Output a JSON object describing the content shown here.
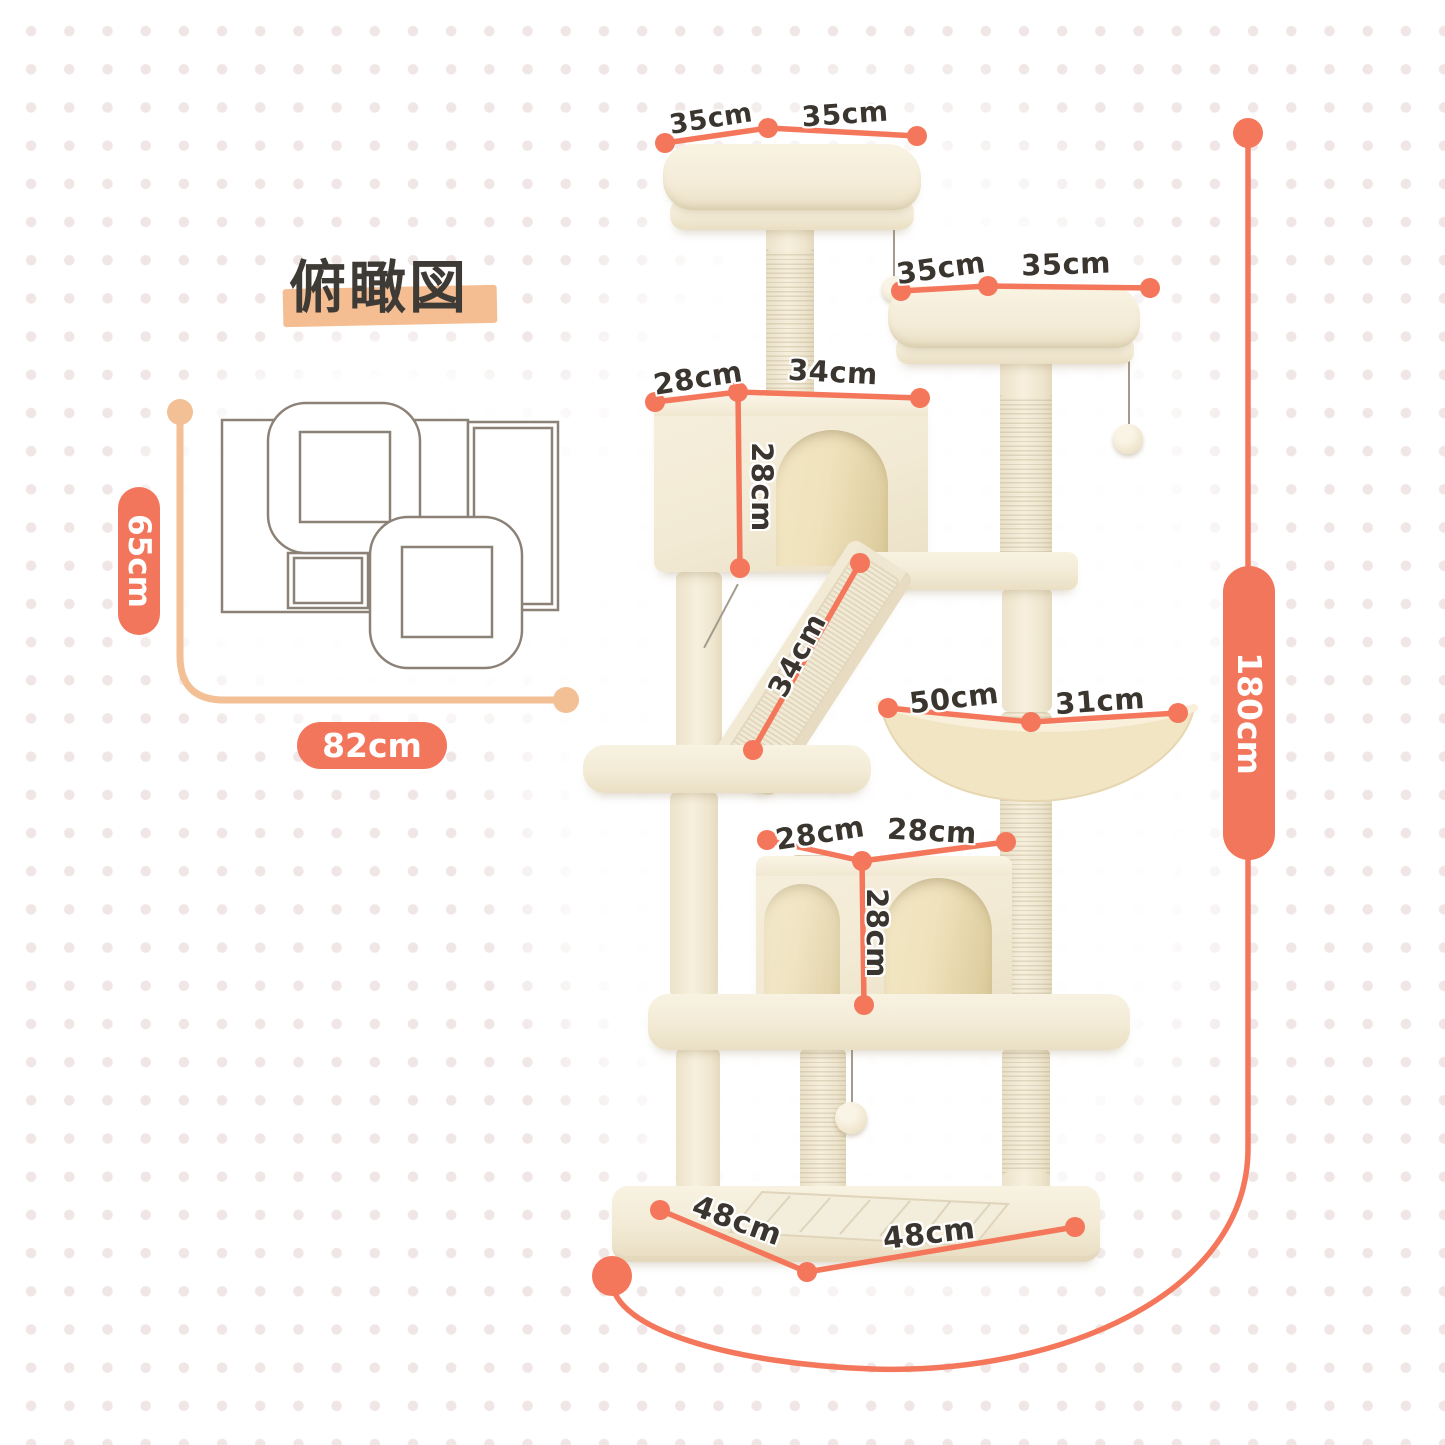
{
  "title": {
    "text": "俯瞰図"
  },
  "top_view": {
    "depth": "65cm",
    "width": "82cm"
  },
  "dimensions": {
    "top_perch_depth": "35cm",
    "top_perch_width": "35cm",
    "second_perch_depth": "35cm",
    "second_perch_width": "35cm",
    "upper_condo_depth": "28cm",
    "upper_condo_width": "34cm",
    "upper_condo_height": "28cm",
    "ramp_length": "34cm",
    "hammock_width": "50cm",
    "hammock_depth": "31cm",
    "lower_condo_depth": "28cm",
    "lower_condo_width": "28cm",
    "lower_condo_height": "28cm",
    "base_depth": "48cm",
    "base_width": "48cm",
    "total_height": "180cm"
  },
  "colors": {
    "dimension_coral": "#F4765B",
    "connector_peach": "#F3BF94",
    "title_highlight": "#F4BE92",
    "label_text": "#3A352E",
    "outline_gray": "#8C8177",
    "tree_cream": "#F5EEDB",
    "background_dot": "#EFE6E5"
  }
}
